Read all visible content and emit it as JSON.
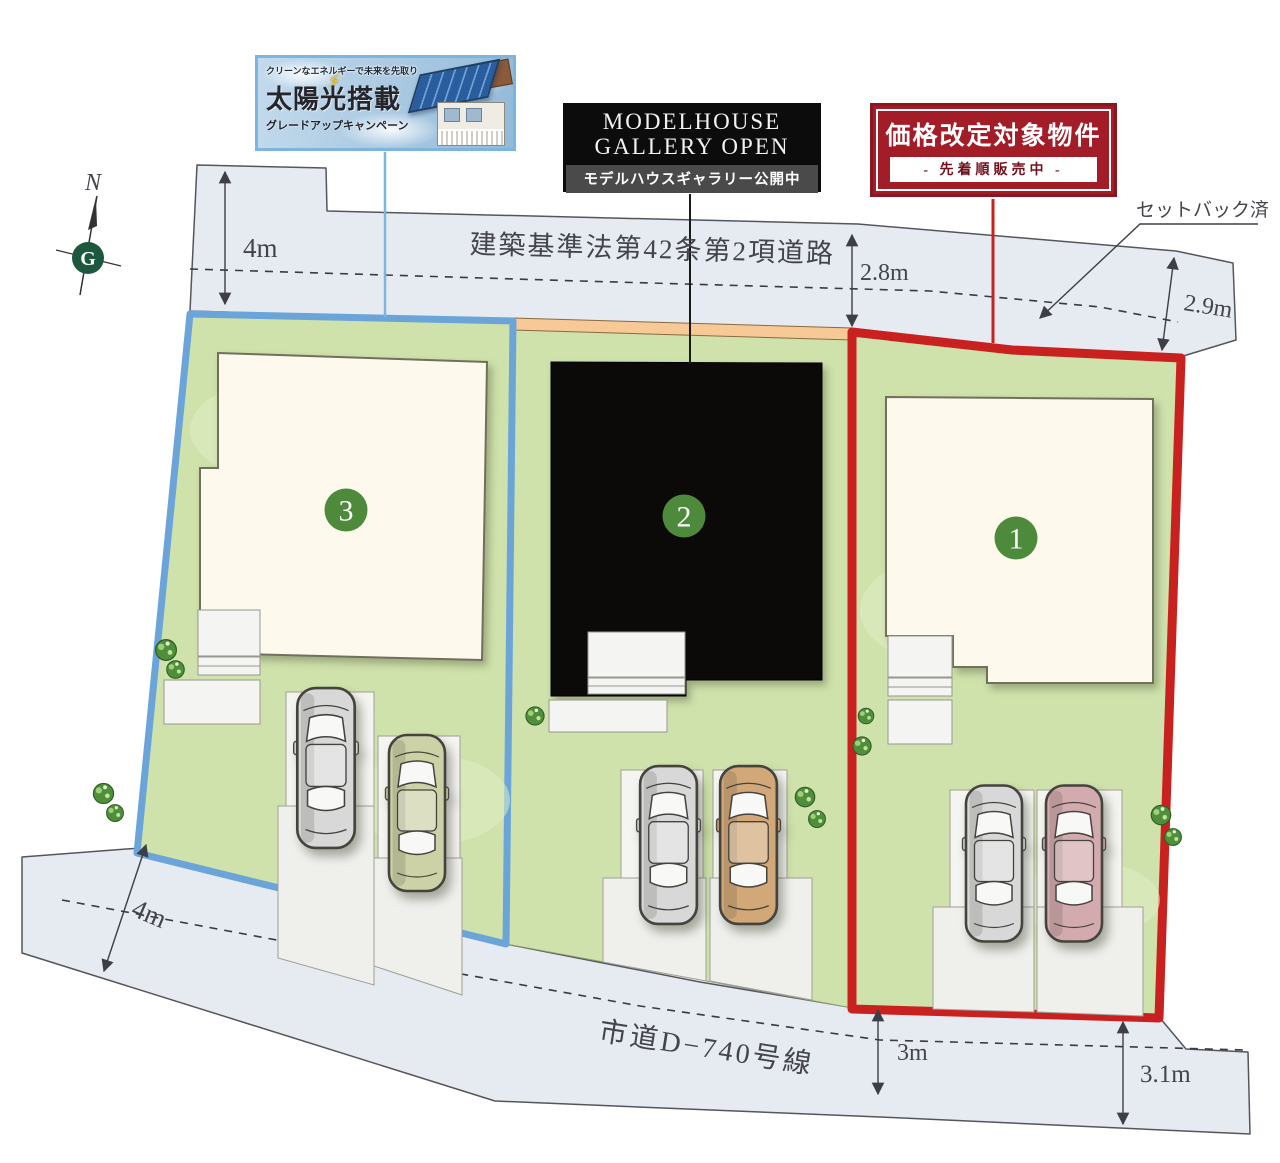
{
  "plan": {
    "banners": {
      "solar": {
        "tagline": "クリーンなエネルギーで未来を先取り",
        "title": "太陽光搭載",
        "subtitle": "グレードアップキャンペーン"
      },
      "modelhouse": {
        "title_line1": "MODELHOUSE",
        "title_line2": "GALLERY OPEN",
        "subtitle": "モデルハウスギャラリー公開中"
      },
      "price": {
        "title": "価格改定対象物件",
        "subtitle": "- 先着順販売中 -"
      }
    },
    "roads": {
      "top_label": "建築基準法第42条第2項道路",
      "bottom_label": "市道D−740号線",
      "setback_note": "セットバック済"
    },
    "measurements": {
      "top_left": "4m",
      "top_center": "2.8m",
      "top_right": "2.9m",
      "bottom_left": "4m",
      "bottom_center": "3m",
      "bottom_right": "3.1m"
    },
    "compass": {
      "north": "N",
      "monogram": "G"
    },
    "lots": {
      "lot1": {
        "number": "1"
      },
      "lot2": {
        "number": "2"
      },
      "lot3": {
        "number": "3"
      }
    },
    "colors": {
      "lot1_border": "#c8211f",
      "lot3_border": "#6ba4d9",
      "lawn": "#cfe2ab",
      "road": "#e6eaf1",
      "lot_number_bg": "#4e8a3b",
      "setback_strip": "#f7c996"
    }
  }
}
